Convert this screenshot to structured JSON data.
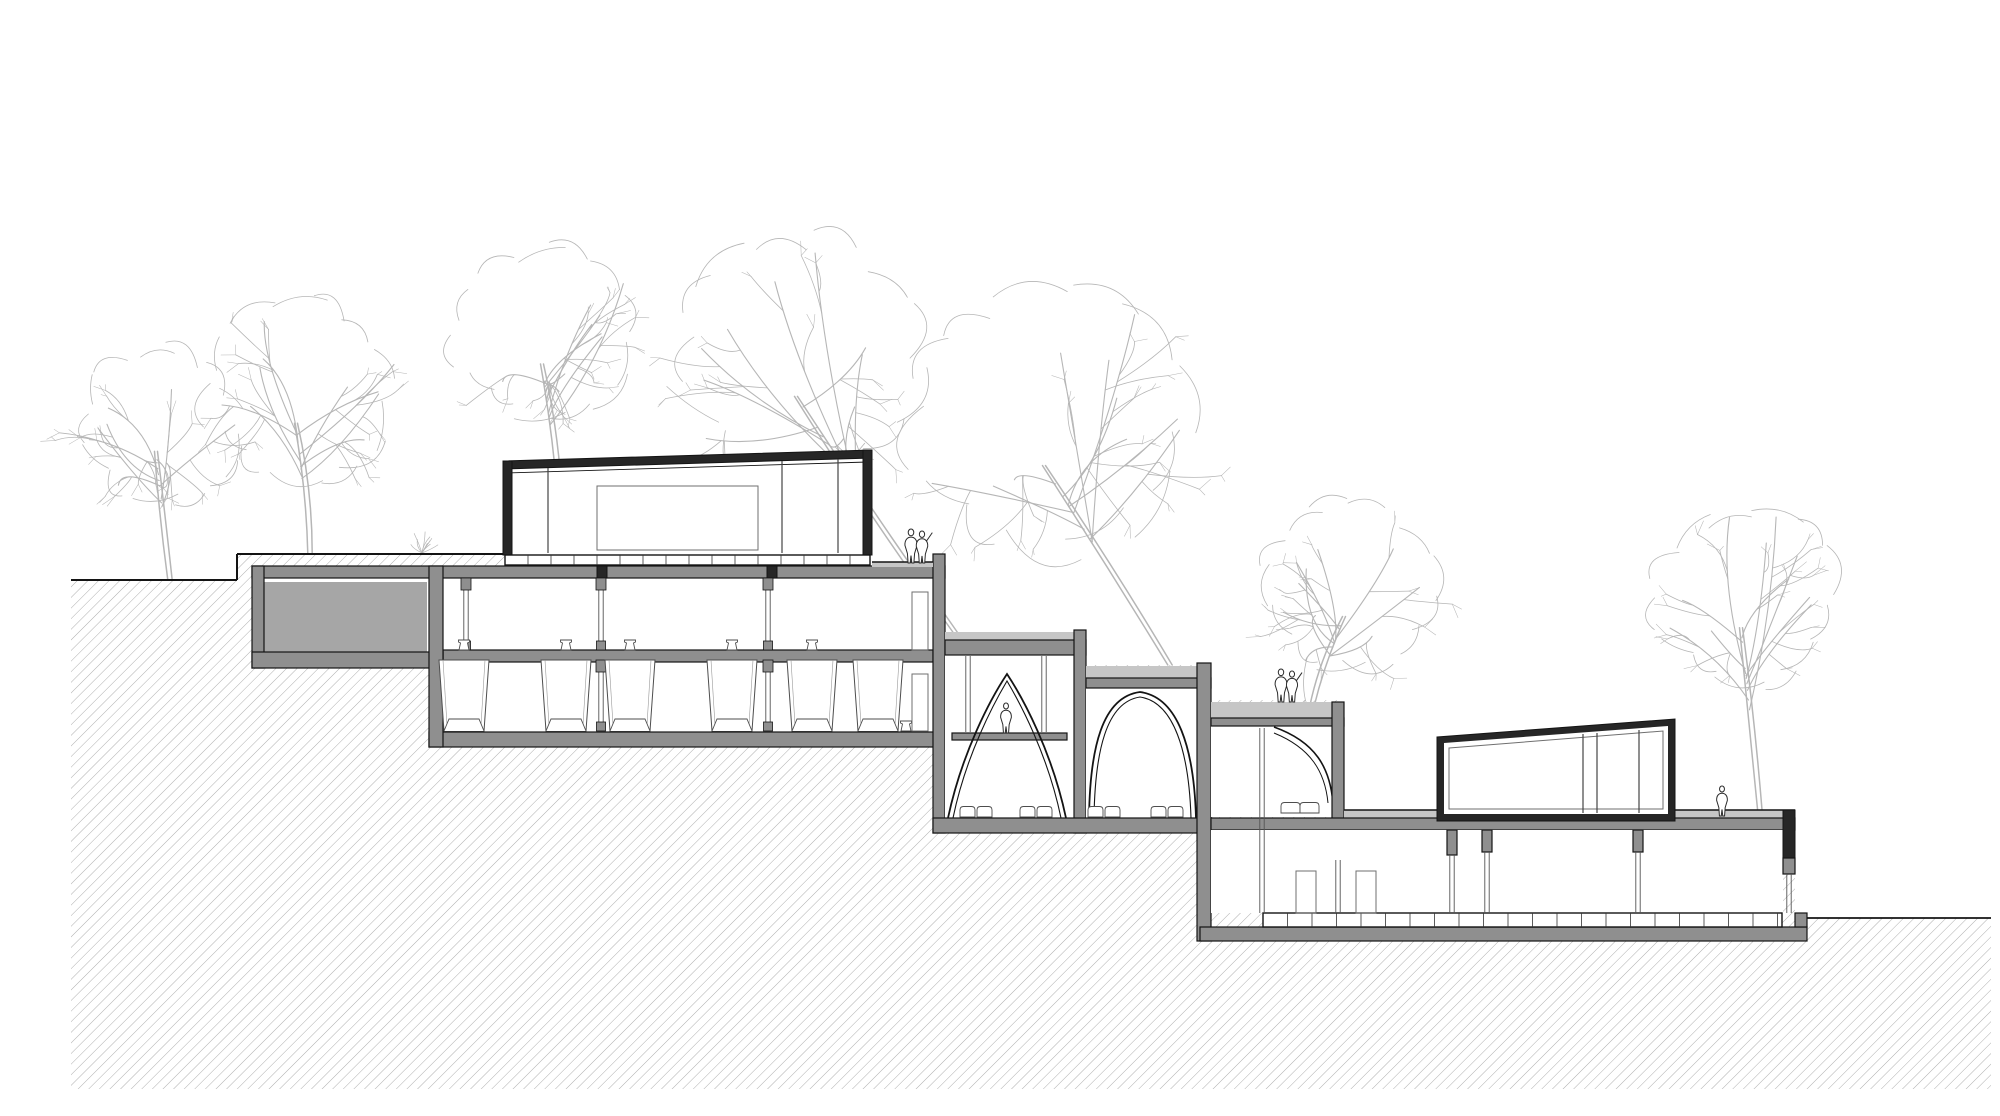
{
  "meta": {
    "drawing_type": "architectural cross-section drawing",
    "site": "stepped hillside section with trees"
  },
  "colors": {
    "background": "#ffffff",
    "line": "#141414",
    "wall_fill": "#8f8f8f",
    "wall_dark": "#262626",
    "slab_light": "#c6c6c6",
    "pool_fill": "#a6a6a6",
    "hatch_line": "#9a9a9a",
    "tree_line": "#b6b6b6",
    "figure_line": "#2b2b2b",
    "furniture_line": "#4d4d4d",
    "window_line": "#6f6f6f"
  },
  "trees": [
    {
      "x": 170,
      "y": 580,
      "cx": 160,
      "cy": 425,
      "r": 88,
      "seed": 11
    },
    {
      "x": 310,
      "y": 554,
      "cx": 300,
      "cy": 392,
      "r": 104,
      "seed": 22
    },
    {
      "x": 560,
      "y": 500,
      "cx": 546,
      "cy": 334,
      "r": 100,
      "seed": 44
    },
    {
      "x": 955,
      "y": 632,
      "cx": 800,
      "cy": 355,
      "r": 138,
      "seed": 55
    },
    {
      "x": 1170,
      "y": 665,
      "cx": 1048,
      "cy": 420,
      "r": 152,
      "seed": 66
    },
    {
      "x": 1312,
      "y": 706,
      "cx": 1348,
      "cy": 588,
      "r": 95,
      "seed": 77
    },
    {
      "x": 1760,
      "y": 812,
      "cx": 1745,
      "cy": 598,
      "r": 99,
      "seed": 88
    }
  ],
  "bush": {
    "x": 422,
    "y": 553,
    "r": 20,
    "seed": 5
  },
  "people": [
    {
      "kind": "pair",
      "x": 916,
      "y": 563,
      "h": 34
    },
    {
      "kind": "single",
      "x": 1006,
      "y": 733,
      "h": 30
    },
    {
      "kind": "pair",
      "x": 1286,
      "y": 702,
      "h": 33
    },
    {
      "kind": "single",
      "x": 1722,
      "y": 816,
      "h": 30
    }
  ],
  "stools": [
    [
      464,
      650
    ],
    [
      566,
      650
    ],
    [
      630,
      650
    ],
    [
      732,
      650
    ],
    [
      812,
      650
    ],
    [
      906,
      731
    ]
  ],
  "cushion_pairs": [
    [
      976,
      817
    ],
    [
      1036,
      817
    ],
    [
      1104,
      817
    ],
    [
      1167,
      817
    ]
  ],
  "bed": {
    "x": 1300,
    "y": 813,
    "w": 38,
    "h": 12
  },
  "canopy_units": {
    "centers": [
      464,
      566,
      630,
      732,
      812,
      878
    ],
    "top": 660,
    "bottom": 731,
    "top_half": 25,
    "bot_half": 20,
    "seat_top": 719,
    "seat_top_half": 15,
    "seat_bot_half": 20
  },
  "doors": [
    {
      "x": 912,
      "y": 592,
      "w": 16,
      "h": 58
    },
    {
      "x": 912,
      "y": 674,
      "w": 16,
      "h": 57
    },
    {
      "x": 1296,
      "y": 871,
      "w": 20,
      "h": 42
    },
    {
      "x": 1356,
      "y": 871,
      "w": 20,
      "h": 42
    }
  ],
  "decks": [
    {
      "x1": 505,
      "x2": 870,
      "y1": 555,
      "y2": 565,
      "step": 23
    },
    {
      "x1": 1263,
      "x2": 1782,
      "y1": 913,
      "y2": 927,
      "step": 24.5
    }
  ],
  "glass_partitions": [
    {
      "x": 466,
      "y1": 580,
      "y2": 650,
      "caps": true
    },
    {
      "x": 601,
      "y1": 580,
      "y2": 650,
      "caps": true
    },
    {
      "x": 768,
      "y1": 580,
      "y2": 650,
      "caps": true
    },
    {
      "x": 601,
      "y1": 662,
      "y2": 731,
      "caps": true
    },
    {
      "x": 768,
      "y1": 662,
      "y2": 731,
      "caps": true
    },
    {
      "x": 968,
      "y1": 656,
      "y2": 732,
      "caps": false
    },
    {
      "x": 1044,
      "y1": 656,
      "y2": 732,
      "caps": false
    },
    {
      "x": 1262,
      "y1": 728,
      "y2": 913,
      "caps": false
    },
    {
      "x": 1452,
      "y1": 855,
      "y2": 913,
      "caps": false
    },
    {
      "x": 1487,
      "y1": 852,
      "y2": 913,
      "caps": false
    },
    {
      "x": 1638,
      "y1": 852,
      "y2": 913,
      "caps": false
    },
    {
      "x": 1338,
      "y1": 860,
      "y2": 913,
      "caps": false
    },
    {
      "x": 1789,
      "y1": 874,
      "y2": 913,
      "caps": false
    }
  ],
  "mullions": [
    {
      "x": 548,
      "y1": 468,
      "y2": 553
    },
    {
      "x": 782,
      "y1": 461,
      "y2": 553
    },
    {
      "x": 838,
      "y1": 459,
      "y2": 553
    },
    {
      "x": 1583,
      "y1": 734,
      "y2": 813
    },
    {
      "x": 1597,
      "y1": 733,
      "y2": 813
    },
    {
      "x": 1639,
      "y1": 730,
      "y2": 813
    }
  ]
}
